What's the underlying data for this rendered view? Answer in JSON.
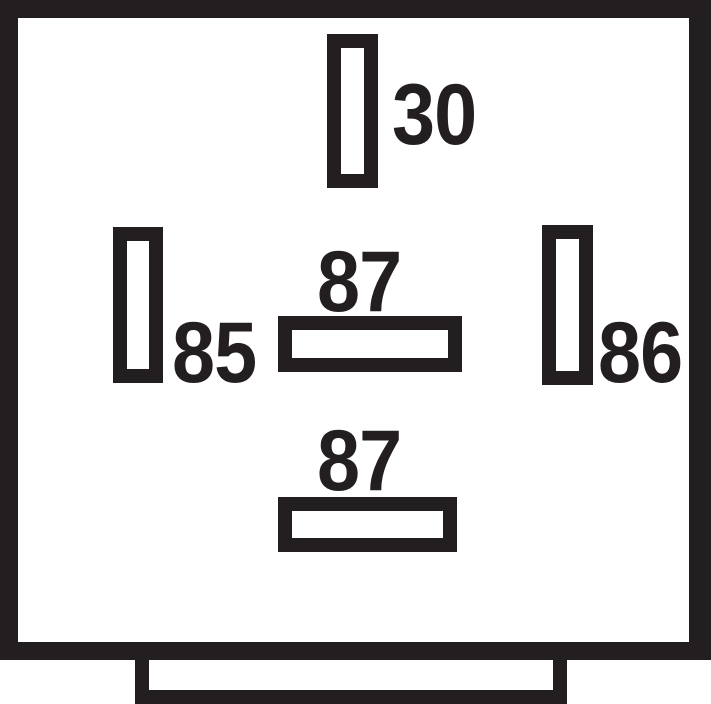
{
  "colors": {
    "ink": "#231f20",
    "paper": "#ffffff"
  },
  "relay": {
    "pins": [
      {
        "id": "pin-30",
        "label": "30",
        "orientation": "vertical",
        "position": "top-center"
      },
      {
        "id": "pin-85",
        "label": "85",
        "orientation": "vertical",
        "position": "middle-left"
      },
      {
        "id": "pin-86",
        "label": "86",
        "orientation": "vertical",
        "position": "middle-right"
      },
      {
        "id": "pin-87",
        "label": "87",
        "orientation": "horizontal",
        "position": "center"
      },
      {
        "id": "pin-87-second",
        "label": "87",
        "orientation": "horizontal",
        "position": "bottom-center"
      }
    ]
  }
}
